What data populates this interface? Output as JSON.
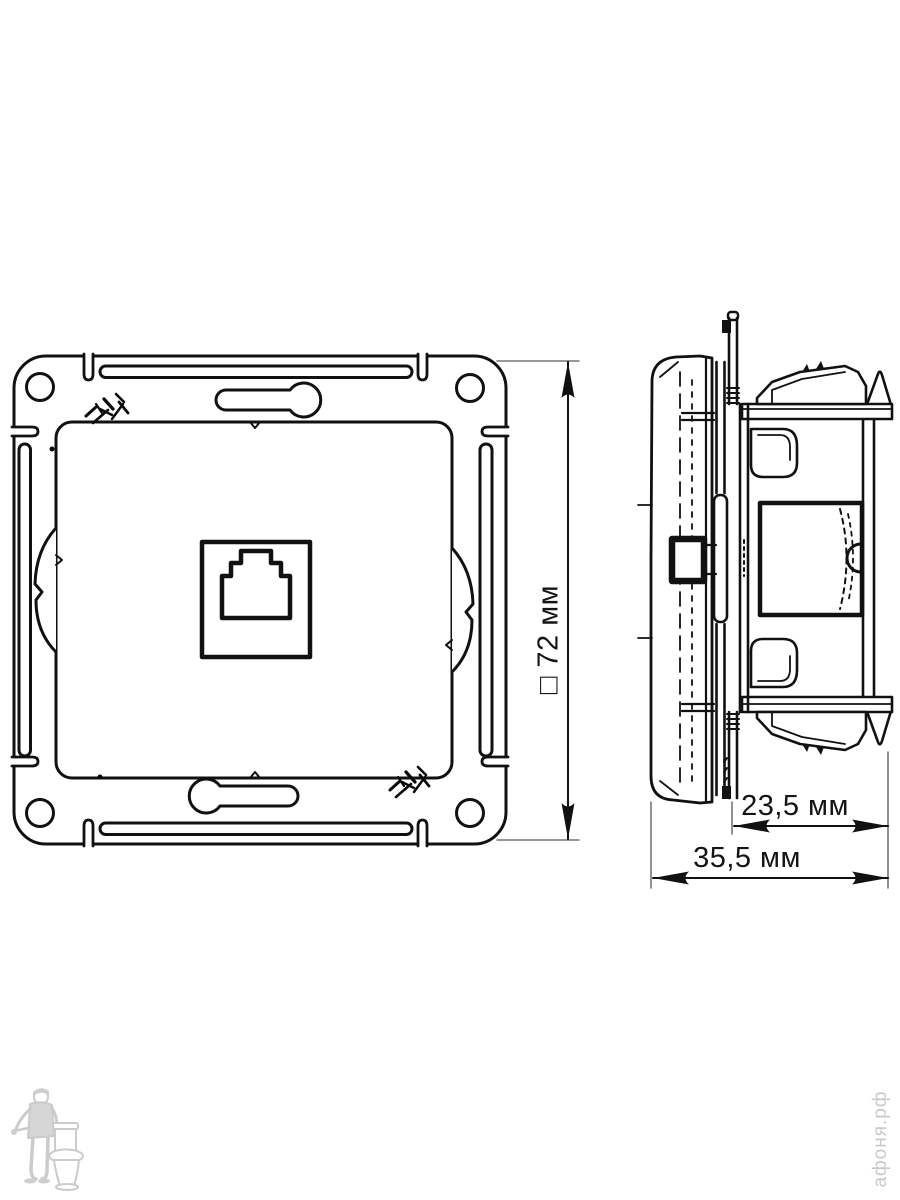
{
  "page": {
    "background": "#ffffff"
  },
  "drawing": {
    "dimension_labels": {
      "front_size": "□ 72 мм",
      "mount_depth": "23,5 мм",
      "total_depth": "35,5 мм"
    },
    "watermark_text": "афоня.рф",
    "colors": {
      "line": "#111111",
      "extension_line": "#777777",
      "watermark": "#c9c9c9"
    }
  }
}
